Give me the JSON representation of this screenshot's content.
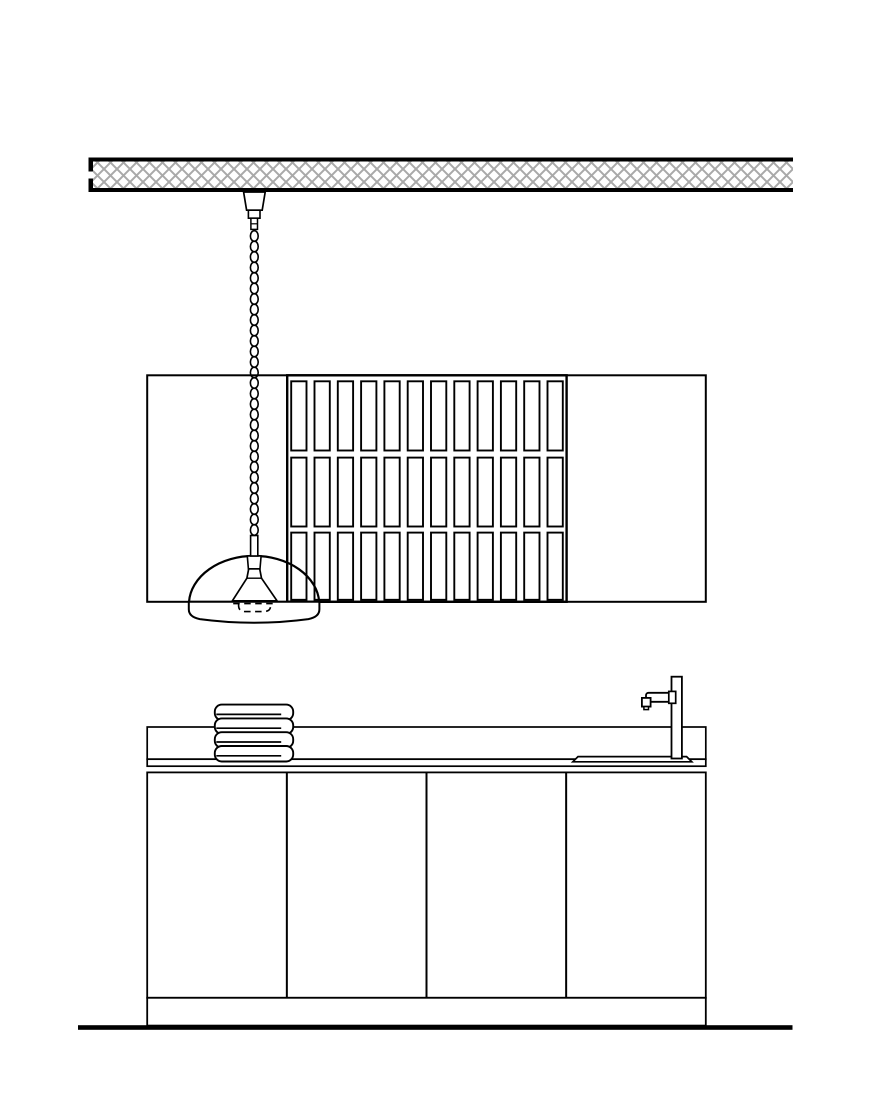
{
  "meta": {
    "title": "kitchen-elevation-drawing",
    "width": 870,
    "height": 1110,
    "visible_text": []
  },
  "palette": {
    "background": "#ffffff",
    "line": "#000000",
    "fill": "#ffffff",
    "hatch": "#a9a9a9"
  },
  "ceiling": {
    "x": 88.5,
    "width": 704.5,
    "top_edge_y": 157.5,
    "edge_thickness": 4,
    "hatch_x": 93,
    "hatch_y": 161.5,
    "hatch_width": 700,
    "hatch_height": 26.5,
    "hatch_tile": 13,
    "hatch_stroke": 2,
    "bottom_edge_y": 188,
    "left_cap_upper": {
      "x": 88.5,
      "y": 157.5,
      "w": 4.5,
      "h": 14
    },
    "left_cap_lower": {
      "x": 88.5,
      "y": 178.5,
      "w": 4.5,
      "h": 13.5
    }
  },
  "pendant": {
    "coil": {
      "cx": 254.3,
      "rx": 3.9,
      "ry": 5.3,
      "first_cy": 236,
      "pitch": 10.5,
      "turns": 29,
      "stroke_width": 1.6
    }
  },
  "upper_cabinet": {
    "x": 147.2,
    "y": 375.3,
    "width": 558.6,
    "height": 226.5,
    "slat_panel": {
      "x": 287.2,
      "y": 375.3,
      "width": 279.4,
      "height": 226.5,
      "columns": 12,
      "first_slat_x": 291.2,
      "pitch": 23.3,
      "slat_width": 15.3,
      "rows": [
        {
          "y": 381.3,
          "height": 69.2
        },
        {
          "y": 457.6,
          "height": 68.9
        },
        {
          "y": 532.6,
          "height": 67.2
        }
      ]
    }
  },
  "counter": {
    "backsplash": {
      "x": 147.2,
      "y": 727,
      "width": 558.6,
      "height": 32.2
    },
    "worktop_edge": {
      "x": 147.2,
      "y": 759.2,
      "width": 558.6,
      "height": 7
    }
  },
  "towels": {
    "count": 4,
    "x": 214.8,
    "width": 78.4,
    "height": 15.5,
    "first_y": 704.6,
    "pitch": 13.8,
    "corner_radius": 7,
    "fold_line_offset_y": 9.8,
    "fold_line_inset_right": 12
  },
  "base_cabinet": {
    "x": 147.2,
    "y": 772.4,
    "width": 558.6,
    "height": 225.4,
    "door_count": 4,
    "plinth": {
      "x": 147.2,
      "y": 997.8,
      "width": 558.6,
      "height": 27.8
    }
  },
  "floor": {
    "x": 78,
    "y": 1025.2,
    "width": 714.5,
    "thickness": 4.6
  }
}
